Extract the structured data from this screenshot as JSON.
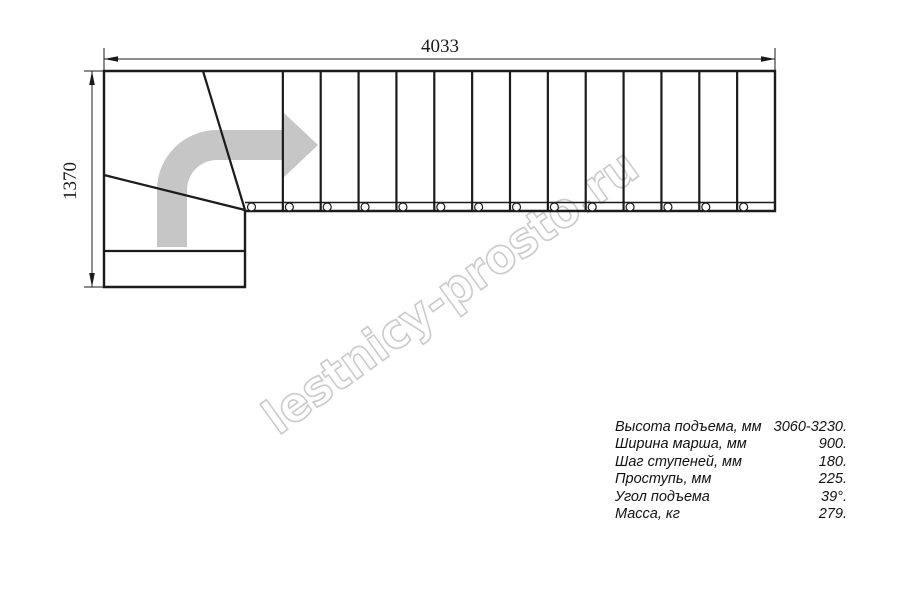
{
  "watermark": {
    "text": "lestnicy-prosto.ru"
  },
  "dimensions": {
    "width_label": "4033",
    "height_label": "1370"
  },
  "stair": {
    "straight_tread_count": 14,
    "divider_count": 13,
    "mount_circle_count": 14
  },
  "colors": {
    "line": "#1b1b1b",
    "arrow_fill": "#c6c6c6",
    "watermark_outline": "#c2c2c2"
  },
  "specs": {
    "rows": [
      {
        "label": "Высота подъема, мм",
        "value": "3060-3230."
      },
      {
        "label": "Ширина марша, мм",
        "value": "900."
      },
      {
        "label": "Шаг ступеней, мм",
        "value": "180."
      },
      {
        "label": "Проступь, мм",
        "value": "225."
      },
      {
        "label": "Угол подъема",
        "value": "39°."
      },
      {
        "label": "Масса, кг",
        "value": "279."
      }
    ]
  }
}
